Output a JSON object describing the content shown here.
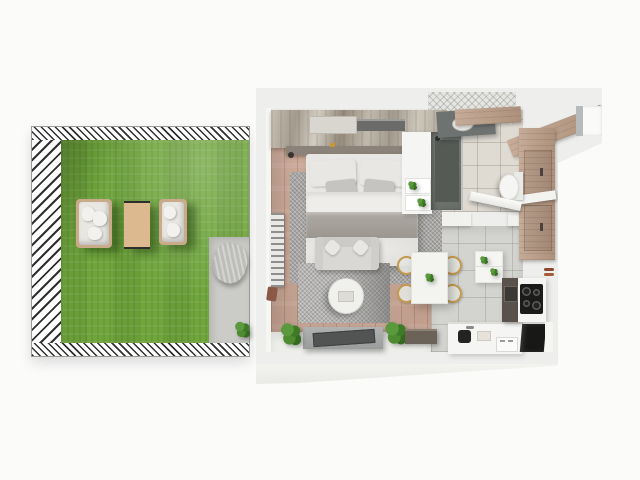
{
  "scene": {
    "title": "Studio apartment 3D floor plan with garden terrace",
    "view": "top-down 3D render",
    "canvas": {
      "width": 640,
      "height": 480
    }
  },
  "colors": {
    "background": "#fbfbfa",
    "wall": "#eeeeec",
    "hatch_stripe": "#2f2f2f",
    "grass": "#6fa53c",
    "concrete_pad": "#cbcbc7",
    "outdoor_wood": "#c9ab8a",
    "outdoor_table": "#dcb98f",
    "cushion_white": "#e9e7e2",
    "wood_floor": "#c7a391",
    "rug_gray": "#a6a5a3",
    "marble_top": "#b3ac9f",
    "bed_linen": "#e8e7e4",
    "blanket_gray": "#aeaaa4",
    "sofa_gray": "#d9d8d5",
    "tv_dark": "#515453",
    "plant_green": "#4c8c32",
    "bath_tile": "#dfdbd3",
    "kitchen_tile": "#d3d3cf",
    "shower_gray": "#676c67",
    "door_wood": "#bb9d86",
    "unit_white": "#f5f5f3",
    "sink_black": "#232322",
    "hob_black": "#1b1b1a",
    "chair_gold": "#c49a4e",
    "cabinet_dark": "#6c6358",
    "doorway_black": "#181816"
  },
  "terrace": {
    "name": "Garden terrace",
    "surface": "grass lawn",
    "border": "diagonal hatched decking",
    "furniture": [
      {
        "name": "outdoor loveseat left"
      },
      {
        "name": "wooden coffee table"
      },
      {
        "name": "outdoor loveseat right"
      },
      {
        "name": "concrete patio pad"
      },
      {
        "name": "lounge chair"
      },
      {
        "name": "potted plant"
      }
    ]
  },
  "apartment": {
    "name": "Studio apartment",
    "rooms": [
      {
        "name": "Sleeping and living area",
        "floor": "wood planks",
        "furniture": [
          "wardrobe with marble top",
          "double bed",
          "pendant bedside lamps",
          "fluffy gray rug",
          "two-seat sofa",
          "speckled area rug",
          "round coffee table",
          "TV sideboard",
          "television",
          "potted plants",
          "radiator"
        ]
      },
      {
        "name": "Bathroom",
        "floor": "ceramic tiles",
        "furniture": [
          "walk-in shower",
          "dark vanity with washbasin",
          "wall-hung toilet",
          "open door"
        ]
      },
      {
        "name": "Kitchen and dining",
        "floor": "concrete tiles",
        "furniture": [
          "white dining table",
          "four gold wire chairs",
          "wall shelf",
          "kitchen counter with black sink",
          "dishwasher",
          "induction hob",
          "oven column",
          "dark sideboard",
          "entrance doorway"
        ]
      },
      {
        "name": "Hallway",
        "floor": "tiles",
        "furniture": [
          "white storage cabinet with open plant shelves"
        ]
      }
    ],
    "features": [
      "angled exterior wall with window niche",
      "wood-clad interior doors"
    ]
  }
}
